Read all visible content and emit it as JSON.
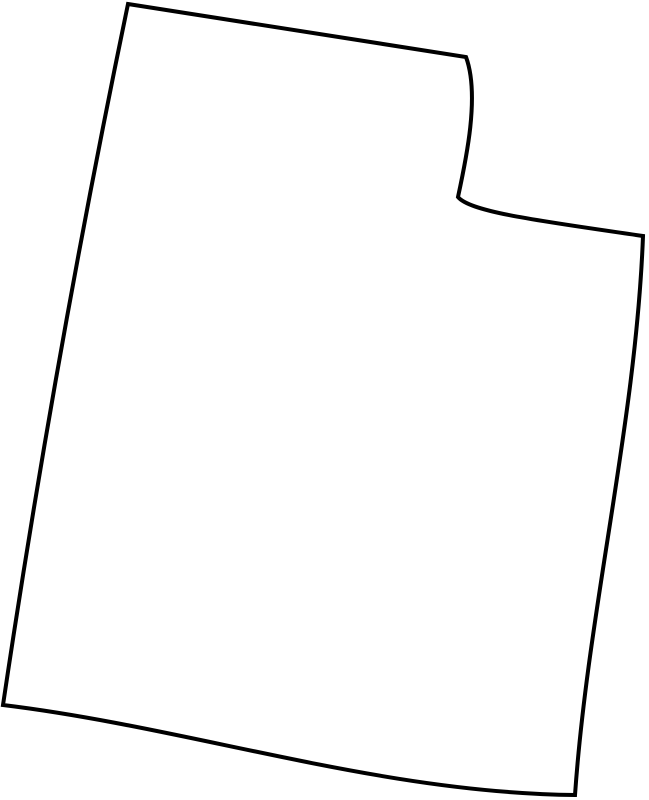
{
  "map": {
    "region_name": "Utah",
    "kind": "blank-state-outline-map",
    "outline_path": "M 128,4 Q 297,31 466,57 C 480,95 466,160 458,197 C 470,212 540,221 643,236 C 636,423 588,609 575,795 C 378,793 192,728 3,705 Q 55,355 128,4 Z",
    "stroke_color": "#000000",
    "fill_color": "#ffffff",
    "stroke_width_px": 4,
    "background_color": "#ffffff"
  }
}
